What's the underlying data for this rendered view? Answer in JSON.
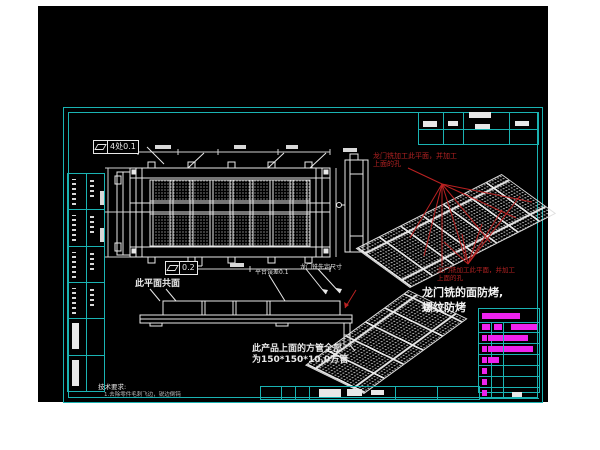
{
  "canvas": {
    "background": "#000000",
    "frame_color": "#1ab3b3"
  },
  "colors": {
    "line_white": "#e8e8e8",
    "annotation_red": "#b22222",
    "bom_magenta": "#ee22ee"
  },
  "tolerances": {
    "top": {
      "symbol": "flatness",
      "value": "4处0.1"
    },
    "mid": {
      "symbol": "flatness",
      "value": "0.2"
    }
  },
  "labels": {
    "coplanar": "此平面共面",
    "platform_error": "平台误差0.1",
    "gantry_size": "龙门铣先定尺寸",
    "red_note_top_line1": "龙门铣加工此平面，并加工",
    "red_note_top_line2": "上面的孔",
    "red_note_bottom_line1": "龙门铣加工此平面，并加工",
    "red_note_bottom_line2": "上面的孔",
    "big_note_line1": "龙门铣的面防烤,",
    "big_note_line2": "螺纹防烤",
    "tube_note_line1": "此产品上面的方管全部",
    "tube_note_line2": "为150*150*10.0方管",
    "tech_req_title": "技术要求:",
    "tech_req_item": "1.去除零件毛刺飞边，锐边倒钝"
  },
  "bom": {
    "header_bar_width": 38,
    "rows": [
      {
        "bars": [
          [
            3,
            8
          ],
          [
            15,
            8
          ],
          [
            32,
            26
          ]
        ]
      },
      {
        "bars": [
          [
            3,
            5
          ],
          [
            9,
            40
          ]
        ]
      },
      {
        "bars": [
          [
            3,
            5
          ],
          [
            9,
            45
          ]
        ]
      },
      {
        "bars": [
          [
            3,
            5
          ],
          [
            9,
            11
          ]
        ]
      },
      {
        "bars": [
          [
            3,
            5
          ]
        ]
      },
      {
        "bars": [
          [
            3,
            5
          ]
        ]
      },
      {
        "bars": [
          [
            3,
            5
          ]
        ]
      }
    ]
  },
  "left_strip": {
    "cells": [
      "text",
      "text",
      "text",
      "text",
      "bar",
      "bar"
    ]
  }
}
